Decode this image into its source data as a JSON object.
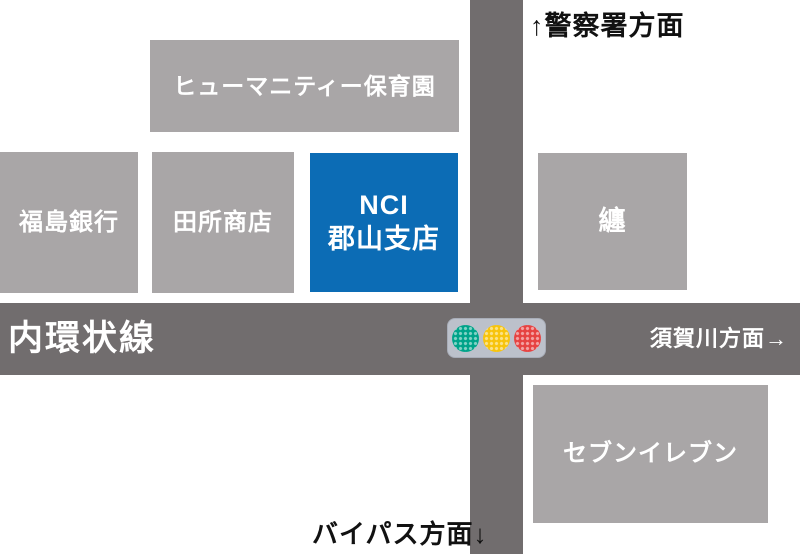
{
  "colors": {
    "background": "#ffffff",
    "road": "#716d6e",
    "building": "#a9a6a7",
    "building_text": "#ffffff",
    "highlight": "#0c6cb5",
    "direction_text": "#111111",
    "traffic_housing": "#bcc1cb",
    "traffic_housing_border": "#a8adb8",
    "traffic_green": "#00a389",
    "traffic_yellow": "#f7c40d",
    "traffic_red": "#e64342"
  },
  "roads": {
    "main_road_label": "内環状線"
  },
  "directions": {
    "north": "↑警察署方面",
    "east": "須賀川方面→",
    "south": "バイパス方面↓"
  },
  "buildings": {
    "nursery": "ヒューマニティー保育園",
    "bank": "福島銀行",
    "shop": "田所商店",
    "nci_line1": "NCI",
    "nci_line2": "郡山支店",
    "matoi": "纏",
    "seven_eleven": "セブンイレブン"
  },
  "traffic_light": {
    "icon": "traffic-light-icon",
    "lights": [
      "green",
      "yellow",
      "red"
    ]
  }
}
